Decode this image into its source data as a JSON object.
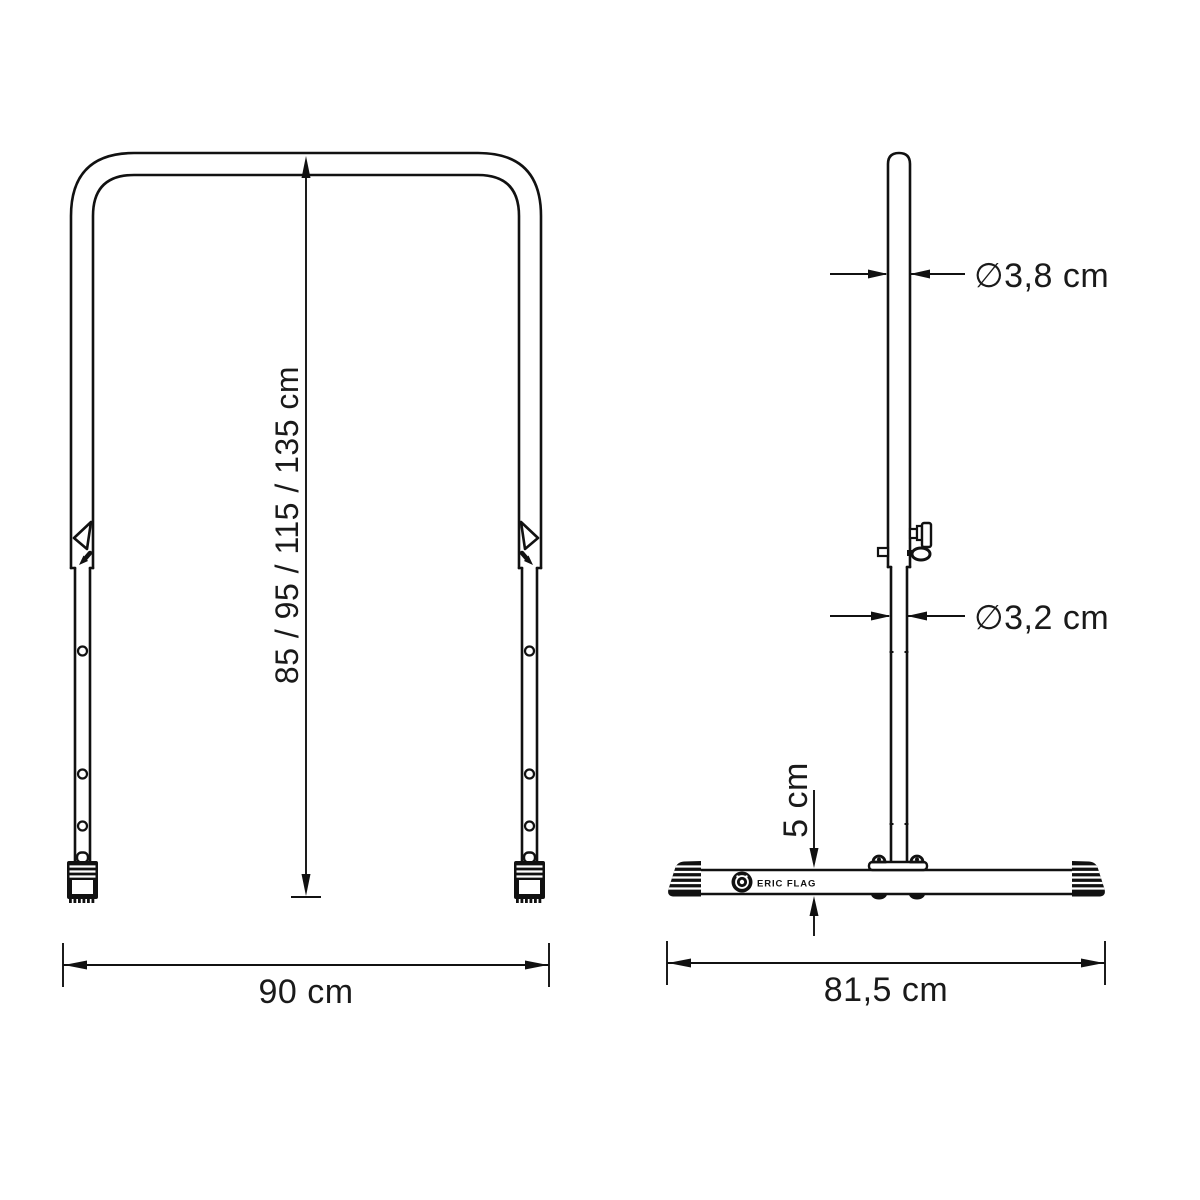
{
  "front_view": {
    "height_dimension_label": "85 / 95 / 115 / 135 cm",
    "width_dimension_label": "90 cm"
  },
  "side_view": {
    "top_tube_diameter_label": "∅3,8 cm",
    "lower_tube_diameter_label": "∅3,2 cm",
    "base_height_label": "5 cm",
    "base_length_label": "81,5 cm",
    "brand_label": "ERIC FLAG"
  },
  "colors": {
    "line": "#111111",
    "background": "#ffffff"
  }
}
